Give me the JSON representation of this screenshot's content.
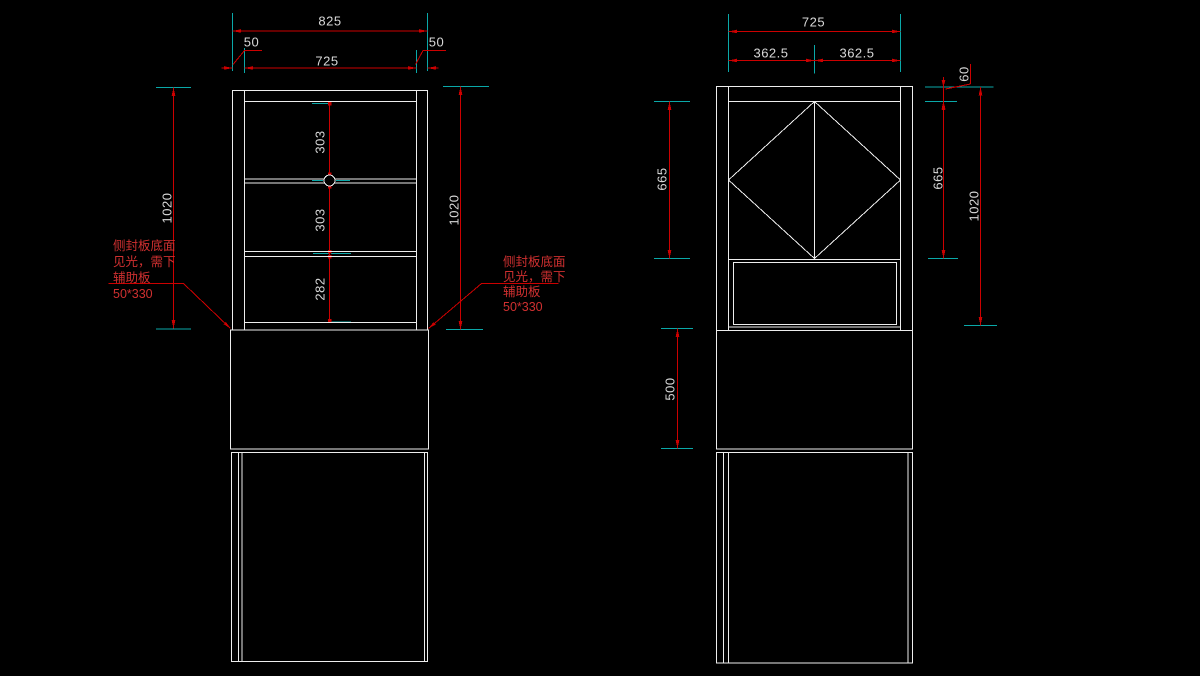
{
  "canvas": {
    "background": "#000000",
    "width": 1200,
    "height": 676
  },
  "colors": {
    "outline": "#ededed",
    "dimension_line": "#cc0000",
    "extension_tick": "#0aa8a8",
    "dimension_text": "#d8d8d8",
    "annotation_text": "#d03030"
  },
  "left_view": {
    "dims": {
      "overall_width": "825",
      "side_overhang_left": "50",
      "inner_width": "725",
      "side_overhang_right": "50",
      "height_left": "1020",
      "height_right": "1020",
      "section_top": "303",
      "section_middle": "303",
      "section_bottom": "282"
    },
    "annotations": {
      "left": {
        "lines": [
          "侧封板底面",
          "见光，需下",
          "辅助板",
          "50*330"
        ]
      },
      "right": {
        "lines": [
          "侧封板底面",
          "见光，需下",
          "辅助板",
          "50*330"
        ]
      }
    }
  },
  "right_view": {
    "dims": {
      "inner_width": "725",
      "half_width_left": "362.5",
      "half_width_right": "362.5",
      "top_rail_height": "60",
      "door_height_left": "665",
      "door_height_right": "665",
      "overall_height": "1020",
      "middle_section_height": "500"
    }
  }
}
